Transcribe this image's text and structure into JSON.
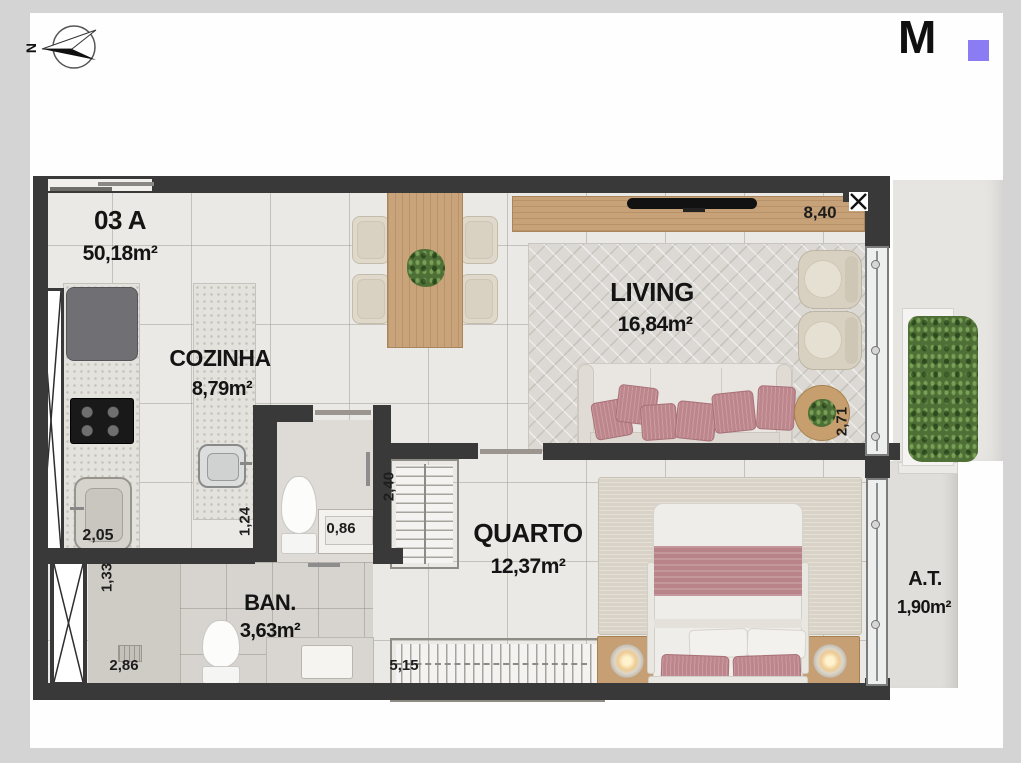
{
  "compass": {
    "label": "N"
  },
  "logo": {
    "letter": "M",
    "accent_color": "#8b7cf3"
  },
  "unit": {
    "code": "03 A",
    "area": "50,18m²"
  },
  "rooms": {
    "cozinha": {
      "name": "COZINHA",
      "area": "8,79m²"
    },
    "living": {
      "name": "LIVING",
      "area": "16,84m²"
    },
    "quarto": {
      "name": "QUARTO",
      "area": "12,37m²"
    },
    "ban": {
      "name": "BAN.",
      "area": "3,63m²"
    },
    "at": {
      "name": "A.T.",
      "area": "1,90m²"
    }
  },
  "dims": {
    "d840": "8,40",
    "d271": "2,71",
    "d205": "2,05",
    "d124": "1,24",
    "d086": "0,86",
    "d240": "2,40",
    "d133": "1,33",
    "d286": "2,86",
    "d515": "5,15"
  },
  "colors": {
    "wall": "#39393a",
    "wood": "#c7a178",
    "pink": "#bd868c",
    "green": "#4e7036",
    "accent": "#8b7cf3"
  }
}
